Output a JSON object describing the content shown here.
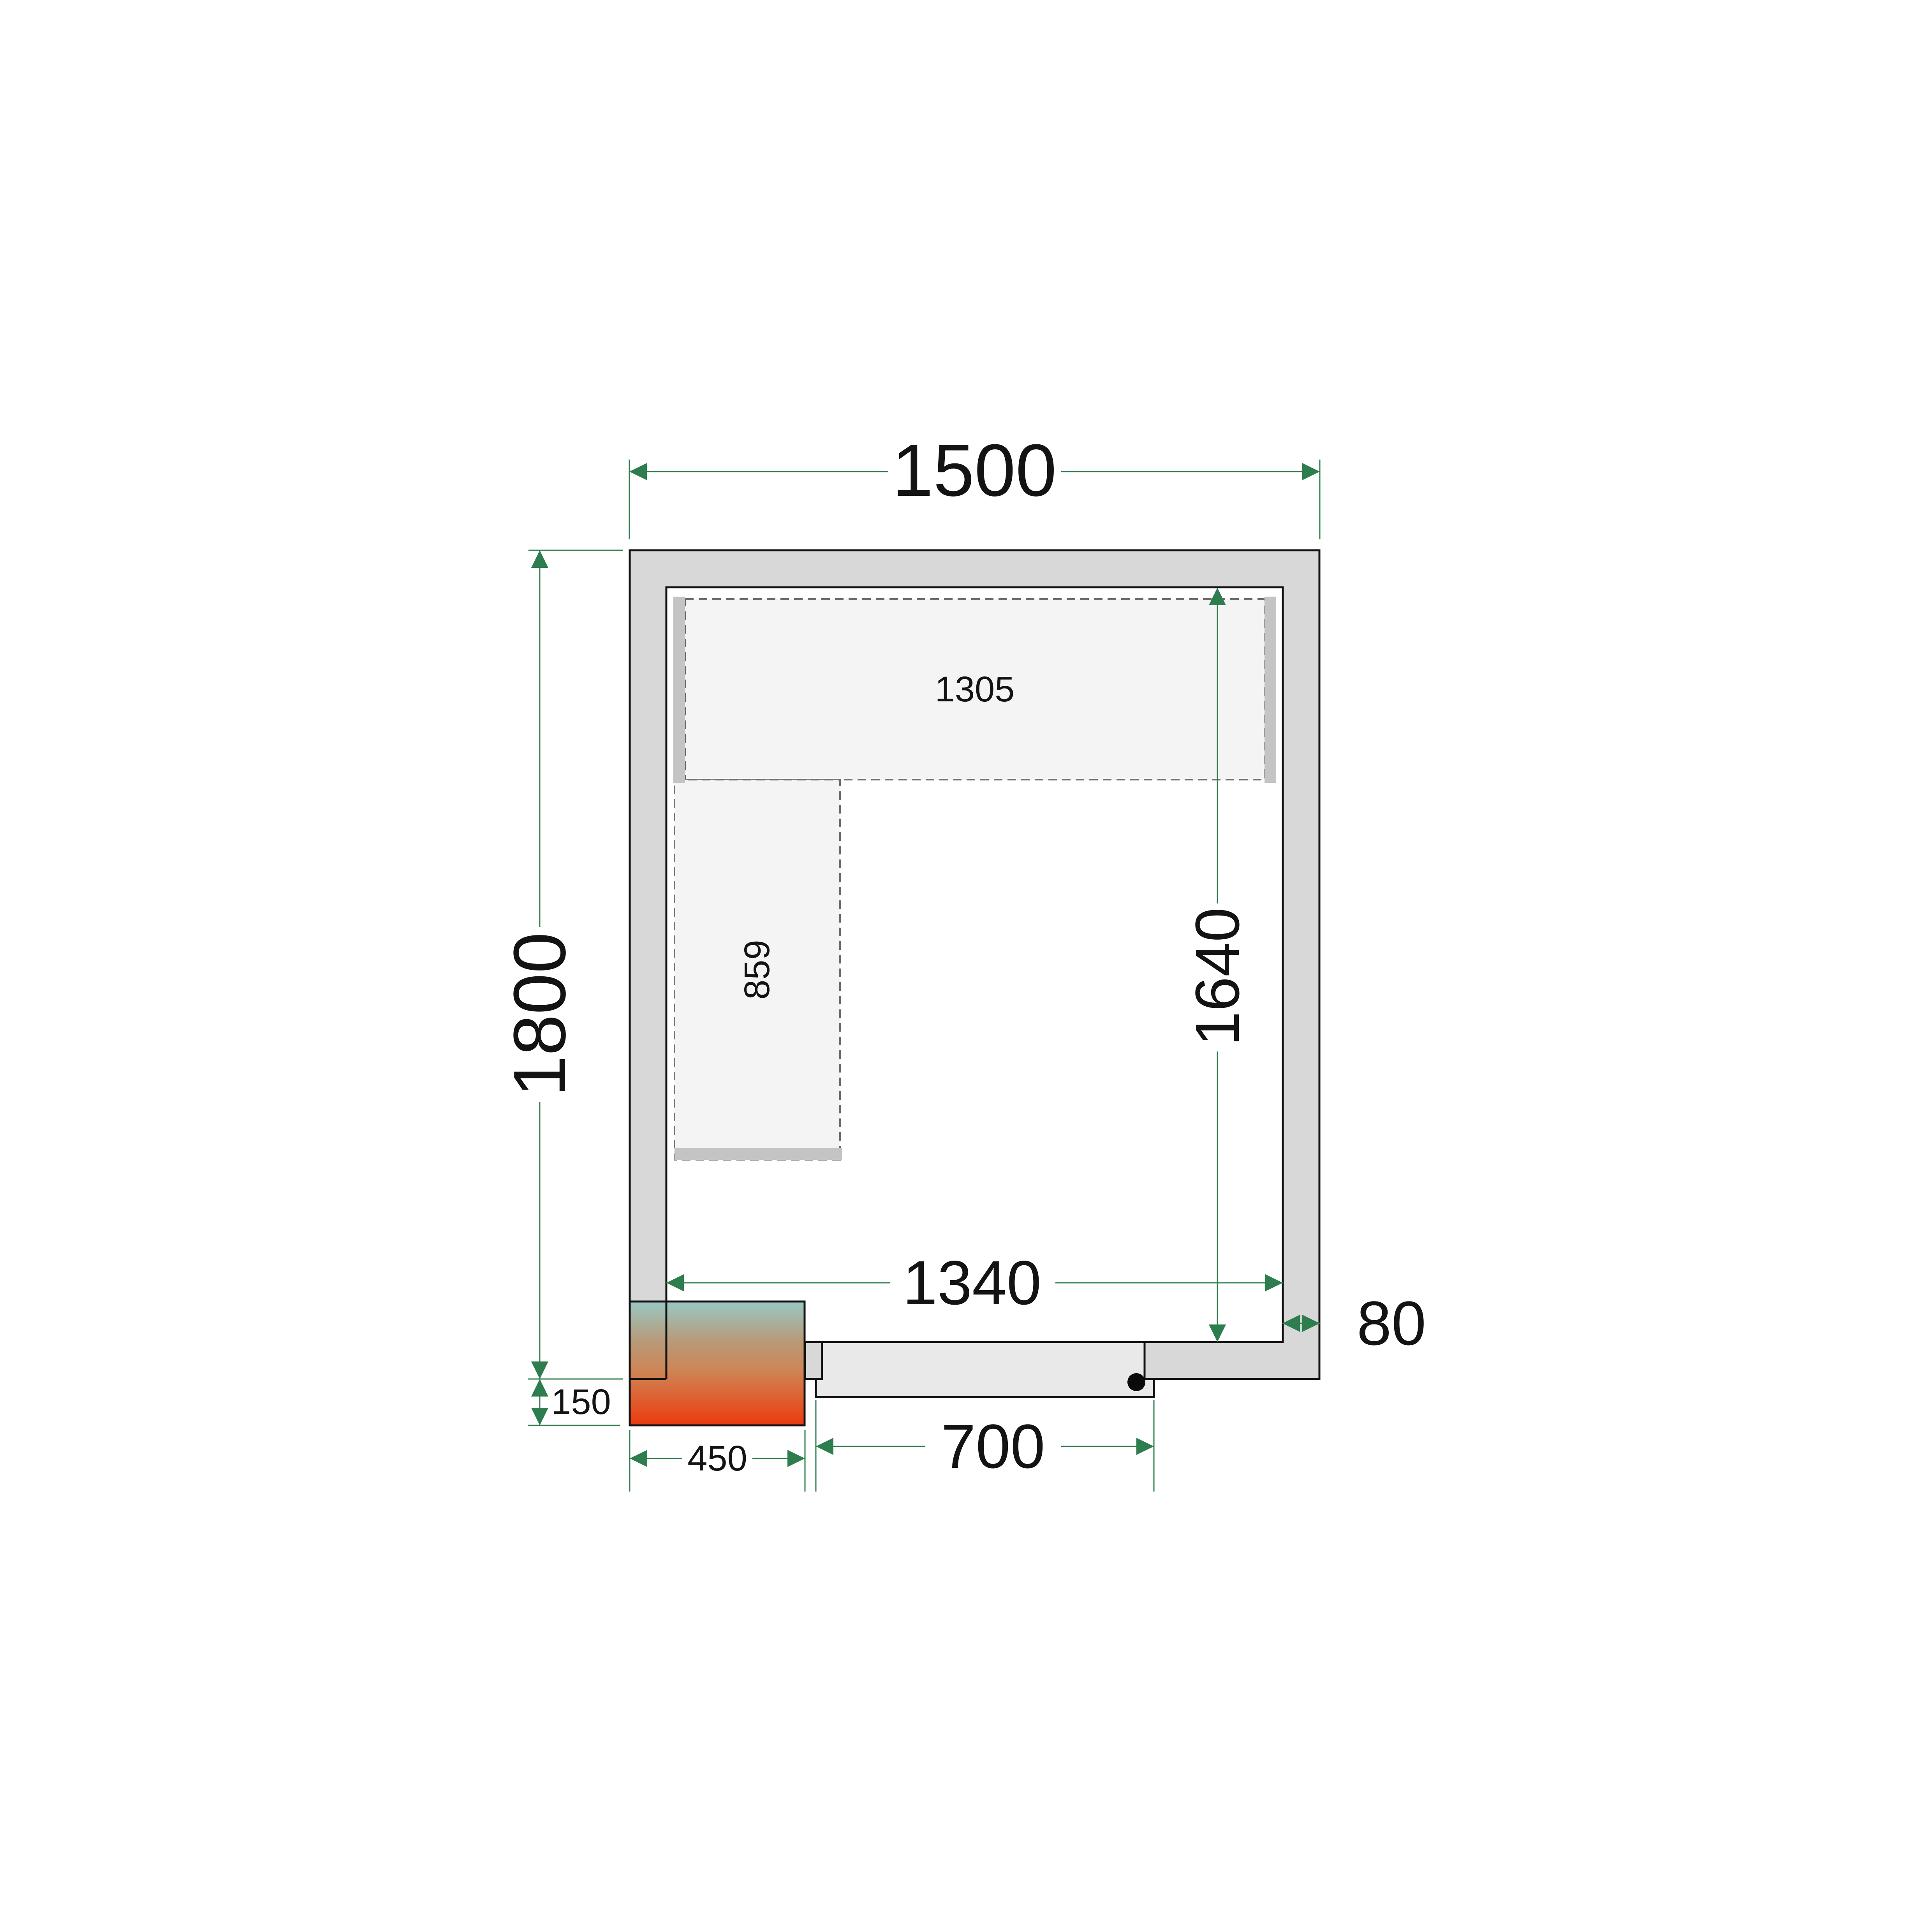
{
  "dimensions": {
    "outer_width": "1500",
    "outer_height": "1800",
    "inner_width": "1340",
    "inner_height": "1640",
    "top_shelf_length": "1305",
    "left_shelf_length": "859",
    "cooling_unit_width": "450",
    "cooling_unit_protrusion": "150",
    "door_width": "700",
    "wall_thickness": "80"
  },
  "colors": {
    "dimension_accent": "#2e7d4e",
    "wall_fill": "#d8d8d8",
    "door_fill": "#e9e9e9",
    "shelf_fill": "#f4f4f4",
    "shelf_bracket_fill": "#c4c4c4",
    "outline": "#111111",
    "unit_gradient_top": "#99c8c4",
    "unit_gradient_mid": "#cd8657",
    "unit_gradient_bottom": "#ea3a0f",
    "handle_dot": "#0b0b0b"
  }
}
